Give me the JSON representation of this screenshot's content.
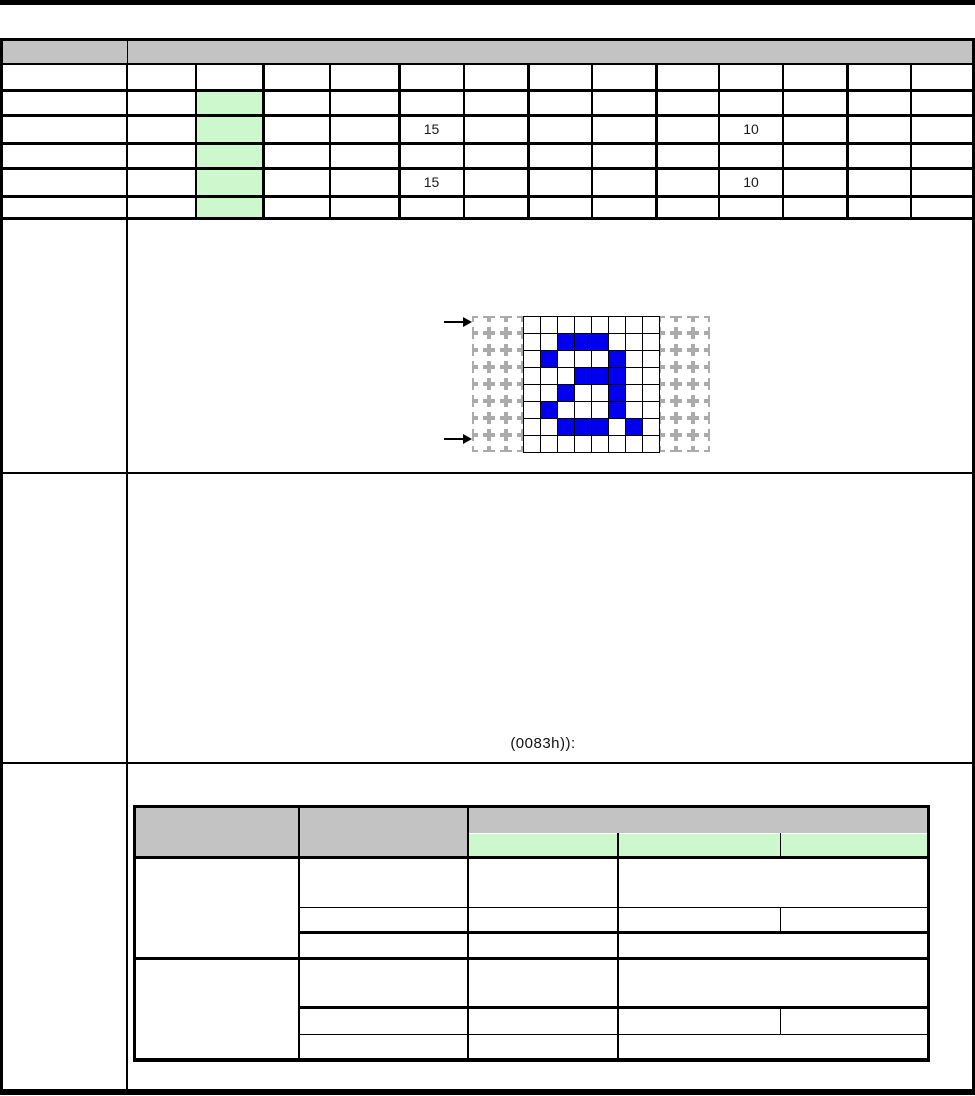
{
  "colors": {
    "border": "#000000",
    "gray_header": "#c3c3c3",
    "green_cell": "#cdf7cd",
    "pixel_blue": "#0000ee",
    "dash_gray": "#ababab",
    "page_bg": "#ffffff"
  },
  "page_frame": {
    "top_rule": {
      "x": 0,
      "y": 0,
      "w": 975,
      "h": 5
    },
    "table_top": 38,
    "bottom_rule": {
      "x": 0,
      "y": 1089,
      "w": 975,
      "h": 6
    },
    "left_border_x": 0,
    "right_border_x": 972,
    "label_col_divider_x": 127,
    "section_divider_ys": [
      218,
      473,
      763
    ],
    "header_band": {
      "y": 41,
      "h": 23
    }
  },
  "top_table": {
    "col_x": [
      0,
      127,
      196,
      263,
      330,
      399,
      464,
      528,
      592,
      656,
      719,
      783,
      847,
      911,
      975
    ],
    "row_y": [
      64,
      90,
      115,
      143,
      168,
      196,
      218
    ],
    "thick_cols": [
      127,
      263,
      399,
      528,
      656,
      847
    ],
    "green_col": 2,
    "green_rows": [
      1,
      2,
      3,
      4,
      5
    ],
    "values": [
      {
        "row": 2,
        "col": 5,
        "text": "15"
      },
      {
        "row": 2,
        "col": 10,
        "text": "10"
      },
      {
        "row": 4,
        "col": 5,
        "text": "15"
      },
      {
        "row": 4,
        "col": 10,
        "text": "10"
      }
    ]
  },
  "glyph_diagram": {
    "depicts": "letter-a-pixel-pattern",
    "origin_x": 472,
    "origin_y": 316,
    "cell": 17,
    "cols": 14,
    "rows": 8,
    "solid_from": 3,
    "solid_to": 10,
    "pixels": [
      [
        1,
        2
      ],
      [
        1,
        3
      ],
      [
        1,
        4
      ],
      [
        2,
        1
      ],
      [
        2,
        5
      ],
      [
        3,
        3
      ],
      [
        3,
        4
      ],
      [
        3,
        5
      ],
      [
        4,
        2
      ],
      [
        4,
        5
      ],
      [
        5,
        1
      ],
      [
        5,
        5
      ],
      [
        6,
        2
      ],
      [
        6,
        3
      ],
      [
        6,
        4
      ],
      [
        6,
        6
      ]
    ],
    "arrows": [
      {
        "y": 322
      },
      {
        "y": 439
      }
    ]
  },
  "note": {
    "text": "(0083h)):"
  },
  "bottom_table": {
    "x": [
      133,
      299,
      468,
      618,
      780,
      930
    ],
    "y_top": 805,
    "y_green_top": 833,
    "y_body": 857,
    "y_row1": 907,
    "y_row2": 932,
    "y_group_sep": 958,
    "y_row3": 1007,
    "y_row4": 1034,
    "y_bottom": 1058
  }
}
